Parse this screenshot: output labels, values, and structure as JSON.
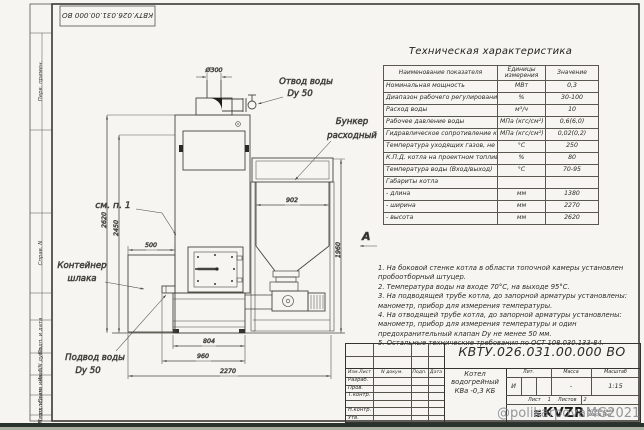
{
  "sheet": {
    "stamp_code": "КВТУ.026.031.00.000 ВО",
    "bottom_watermark": "@polikarpovaMG2021",
    "margin_labels": [
      "Перв. примен.",
      "Справ. N",
      "Подп. и дата",
      "Инв. N дубл.",
      "Взам. инв. N",
      "Подп. и дата",
      "Инв. N подл."
    ]
  },
  "drawing": {
    "dims": {
      "chimney_dia": "Ø300",
      "height_total": "2620",
      "height_body": "2450",
      "container_width": "500",
      "bunker_width": "902",
      "bunker_height": "1960",
      "base_width": "804",
      "base_full": "960",
      "overall_width": "2270"
    },
    "labels": {
      "outlet_1": "Отвод воды",
      "outlet_2": "Dy 50",
      "bunker_1": "Бункер",
      "bunker_2": "расходный",
      "see_note": "см. п. 1",
      "container_1": "Контейнер",
      "container_2": "шлака",
      "inlet_1": "Подвод воды",
      "inlet_2": "Dy 50",
      "view": "А"
    }
  },
  "spec": {
    "title": "Техническая характеристика",
    "col_name": "Наименование показателя",
    "col_units": "Единицы измерения",
    "col_value": "Значение",
    "rows": [
      [
        "Номинальная мощность",
        "МВт",
        "0,3"
      ],
      [
        "Диапазон рабочего регулирования",
        "%",
        "30-100"
      ],
      [
        "Расход воды",
        "м³/ч",
        "10"
      ],
      [
        "Рабочее давление воды",
        "МПа (кгс/см²)",
        "0,6(6,0)"
      ],
      [
        "Гидравлическое сопротивление котла",
        "МПа (кгс/см²)",
        "0,02(0,2)"
      ],
      [
        "Температура уходящих газов, не более",
        "°С",
        "250"
      ],
      [
        "К.П.Д. котла на проектном топливе",
        "%",
        "80"
      ],
      [
        "Температура воды (Вход/выход)",
        "°С",
        "70-95"
      ],
      [
        "Габариты котла",
        "",
        ""
      ],
      [
        "- длина",
        "мм",
        "1380"
      ],
      [
        "- ширина",
        "мм",
        "2270"
      ],
      [
        "- высота",
        "мм",
        "2620"
      ]
    ]
  },
  "notes": [
    "1. На боковой стенке котла в области топочной камеры установлен пробоотборный штуцер.",
    "2. Температура воды на входе 70°С, на выходе 95°С.",
    "3. На подводящей трубе котла, до запорной арматуры установлены: манометр, прибор для измерения температуры.",
    "4. На отводящей трубе котла, до запорной арматуры установлены: манометр, прибор для измерения температуры и один предохранительный клапан Dу не менее 50 мм.",
    "5. Остальные технические требования по ОСТ 108.030.133-84."
  ],
  "title_block": {
    "doc_number": "КВТУ.026.031.00.000 ВО",
    "rev_cols": [
      "Изм.Лист",
      "N докум.",
      "Подп.",
      "Дата"
    ],
    "roles": [
      "Разраб.",
      "Пров.",
      "Т.контр.",
      "Н.контр.",
      "Утв."
    ],
    "product_1": "Котел водогрейный",
    "product_2": "КВа -0,3 КБ",
    "lit_h": "Лит.",
    "mass_h": "Масса",
    "scale_h": "Масштаб",
    "lit": "И",
    "mass": "-",
    "scale": "1:15",
    "sheet_h": "Лист",
    "sheet": "1",
    "sheets_h": "Листов",
    "sheets": "2",
    "logo_mark": "≋",
    "logo": "KVZR",
    "logo_cap_1": "КОТЕЛЬНЫЙ",
    "logo_cap_2": "ЗАВОД РЭП"
  }
}
